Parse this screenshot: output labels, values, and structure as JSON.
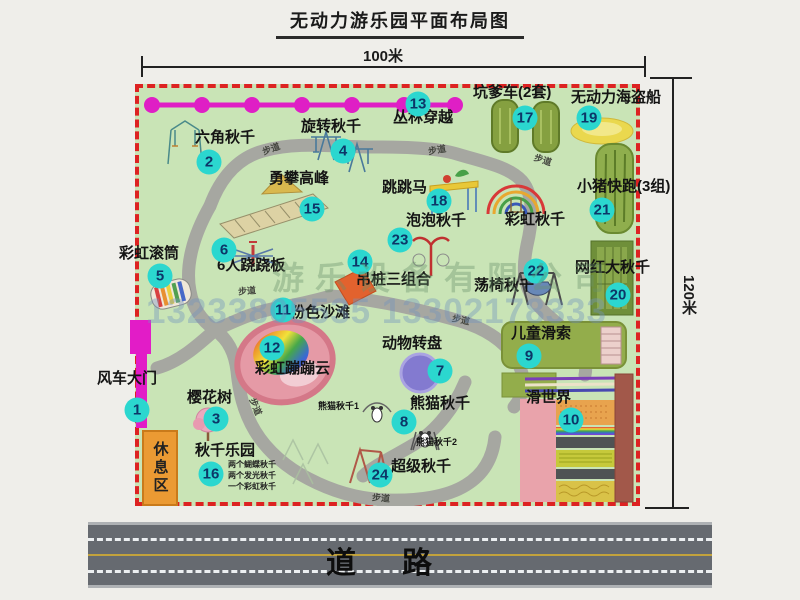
{
  "title": "无动力游乐园平面布局图",
  "dimensions": {
    "top": "100米",
    "right": "120米"
  },
  "road": {
    "label": "道路"
  },
  "watermark": {
    "company": "游乐设备有限公司",
    "phone": "13233805535 13302178333"
  },
  "rest_area_label": "休息区",
  "walkway_text": "步道",
  "colors": {
    "badge": "#2bd7cf",
    "boundary_red": "#dd2222",
    "map_green": "#c9e4b6",
    "gate_magenta": "#e21cc7",
    "road_gray": "#666a70"
  },
  "attractions": [
    {
      "num": "1",
      "label": "风车大门",
      "lx": 97,
      "ly": 371,
      "bx": 137,
      "by": 410
    },
    {
      "num": "2",
      "label": "六角秋千",
      "lx": 195,
      "ly": 130,
      "bx": 209,
      "by": 162
    },
    {
      "num": "3",
      "label": "樱花树",
      "lx": 187,
      "ly": 390,
      "bx": 216,
      "by": 419
    },
    {
      "num": "4",
      "label": "旋转秋千",
      "lx": 301,
      "ly": 119,
      "bx": 343,
      "by": 151
    },
    {
      "num": "5",
      "label": "彩虹滚筒",
      "lx": 119,
      "ly": 246,
      "bx": 160,
      "by": 276
    },
    {
      "num": "6",
      "label": "6人跷跷板",
      "lx": 217,
      "ly": 258,
      "bx": 224,
      "by": 250
    },
    {
      "num": "7",
      "label": "动物转盘",
      "lx": 382,
      "ly": 336,
      "bx": 440,
      "by": 371
    },
    {
      "num": "8",
      "label": "熊猫秋千",
      "lx": 410,
      "ly": 396,
      "bx": 404,
      "by": 422
    },
    {
      "num": "9",
      "label": "儿童滑索",
      "lx": 511,
      "ly": 326,
      "bx": 529,
      "by": 356
    },
    {
      "num": "10",
      "label": "滑世界",
      "lx": 526,
      "ly": 390,
      "bx": 571,
      "by": 420
    },
    {
      "num": "11",
      "label": "粉色沙滩",
      "lx": 290,
      "ly": 305,
      "bx": 283,
      "by": 310
    },
    {
      "num": "12",
      "label": "彩虹蹦蹦云",
      "lx": 255,
      "ly": 361,
      "bx": 272,
      "by": 348
    },
    {
      "num": "13",
      "label": "丛林穿越",
      "lx": 393,
      "ly": 110,
      "bx": 418,
      "by": 104
    },
    {
      "num": "14",
      "label": "吊桩三组合",
      "lx": 356,
      "ly": 272,
      "bx": 360,
      "by": 262
    },
    {
      "num": "15",
      "label": "勇攀高峰",
      "lx": 269,
      "ly": 171,
      "bx": 312,
      "by": 209
    },
    {
      "num": "16",
      "label": "秋千乐园",
      "lx": 195,
      "ly": 443,
      "bx": 211,
      "by": 474,
      "sub": [
        "两个蝴蝶秋千",
        "两个发光秋千",
        "一个彩虹秋千"
      ],
      "subx": 228,
      "suby": 459
    },
    {
      "num": "17",
      "label": "坑爹车(2套)",
      "lx": 473,
      "ly": 85,
      "bx": 525,
      "by": 118
    },
    {
      "num": "18",
      "label": "跳跳马",
      "lx": 382,
      "ly": 180,
      "bx": 439,
      "by": 201
    },
    {
      "num": "19",
      "label": "无动力海盗船",
      "lx": 571,
      "ly": 90,
      "bx": 589,
      "by": 118
    },
    {
      "num": "20",
      "label": "网红大秋千",
      "lx": 575,
      "ly": 260,
      "bx": 618,
      "by": 295
    },
    {
      "num": "21",
      "label": "小猪快跑(3组)",
      "lx": 577,
      "ly": 179,
      "bx": 602,
      "by": 210
    },
    {
      "num": "22",
      "label": "荡椅秋千",
      "lx": 474,
      "ly": 278,
      "bx": 536,
      "by": 271
    },
    {
      "num": "23",
      "label": "泡泡秋千",
      "lx": 406,
      "ly": 213,
      "bx": 400,
      "by": 240
    },
    {
      "num": "24",
      "label": "超级秋千",
      "lx": 391,
      "ly": 459,
      "bx": 380,
      "by": 475
    }
  ],
  "extra_labels": [
    {
      "label": "彩虹秋千",
      "x": 505,
      "y": 212,
      "small": false
    },
    {
      "label": "熊猫秋千1",
      "x": 318,
      "y": 401,
      "small": true
    },
    {
      "label": "熊猫秋千2",
      "x": 416,
      "y": 437,
      "small": true
    }
  ],
  "walkway_labels": [
    {
      "x": 262,
      "y": 142,
      "r": -20
    },
    {
      "x": 428,
      "y": 143,
      "r": -10
    },
    {
      "x": 534,
      "y": 153,
      "r": 18
    },
    {
      "x": 238,
      "y": 284,
      "r": -5
    },
    {
      "x": 452,
      "y": 313,
      "r": 12
    },
    {
      "x": 372,
      "y": 491,
      "r": 5
    },
    {
      "x": 247,
      "y": 400,
      "r": 68
    }
  ]
}
